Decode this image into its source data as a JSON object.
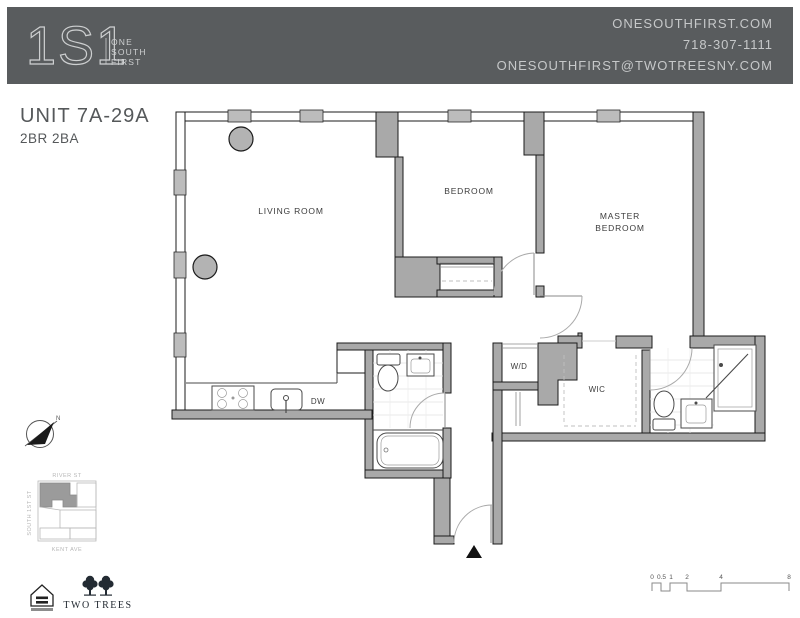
{
  "header": {
    "bg_color": "#595c5e",
    "logo_mark": "1S1",
    "logo_words": [
      "ONE",
      "SOUTH",
      "FIRST"
    ],
    "contact_lines": [
      "ONESOUTHFIRST.COM",
      "718-307-1111",
      "ONESOUTHFIRST@TWOTREESNY.COM"
    ]
  },
  "unit": {
    "title": "UNIT 7A-29A",
    "subtitle": "2BR 2BA"
  },
  "floorplan": {
    "labels": {
      "living_room": "LIVING ROOM",
      "bedroom": "BEDROOM",
      "master_line1": "MASTER",
      "master_line2": "BEDROOM",
      "washer_dryer": "W/D",
      "walk_in_closet": "WIC",
      "dishwasher": "DW"
    },
    "colors": {
      "wall": "#a9a9a9",
      "window": "#bcbcbc",
      "door_arc": "#aaaaaa",
      "tile": "#e2e2e2"
    }
  },
  "compass": {
    "north_label": "N"
  },
  "sitemap": {
    "top_street": "RIVER ST",
    "bottom_street": "KENT AVE",
    "left_street": "SOUTH 1ST ST"
  },
  "footer": {
    "two_trees_label": "TWO TREES"
  },
  "scalebar": {
    "labels": [
      "0",
      "0.5",
      "1",
      "2",
      "4",
      "8"
    ]
  }
}
